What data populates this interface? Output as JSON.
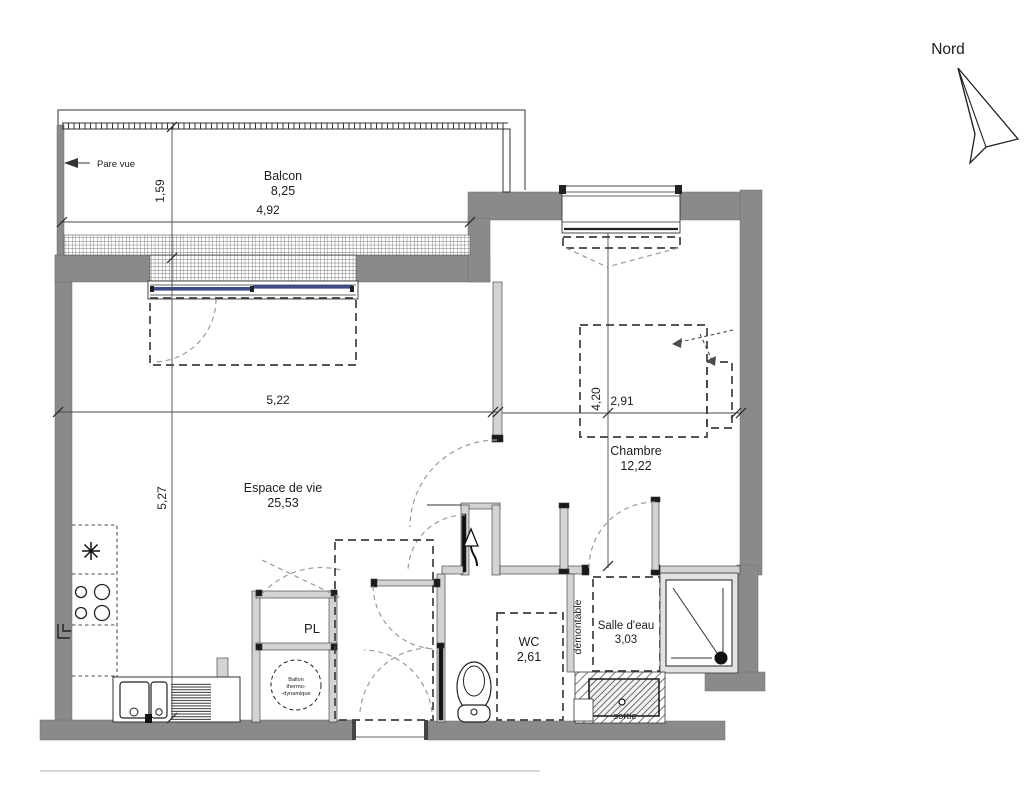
{
  "north": {
    "label": "Nord"
  },
  "balcony": {
    "name": "Balcon",
    "area": "8,25",
    "screen_label": "Pare vue"
  },
  "living": {
    "name": "Espace de vie",
    "area": "25,53"
  },
  "bedroom": {
    "name": "Chambre",
    "area": "12,22"
  },
  "wc": {
    "name": "WC",
    "area": "2,61"
  },
  "bathroom": {
    "name": "Salle d'eau",
    "area": "3,03",
    "partition_label": "démontable",
    "outlet_label": "sortie"
  },
  "closet": {
    "name": "PL"
  },
  "water_heater": {
    "line1": "Ballon",
    "line2": "thermo-",
    "line3": "-dynamique"
  },
  "dimensions": {
    "balcony_depth": "1,59",
    "balcony_width": "4,92",
    "living_width": "5,22",
    "living_depth": "5,27",
    "bedroom_depth": "4,20",
    "bedroom_width": "2,91"
  },
  "colors": {
    "wall": "#8a8a8a",
    "partition": "#d3d3d3",
    "glazing": "#3d4a8f",
    "line": "#333333",
    "background": "#ffffff"
  }
}
